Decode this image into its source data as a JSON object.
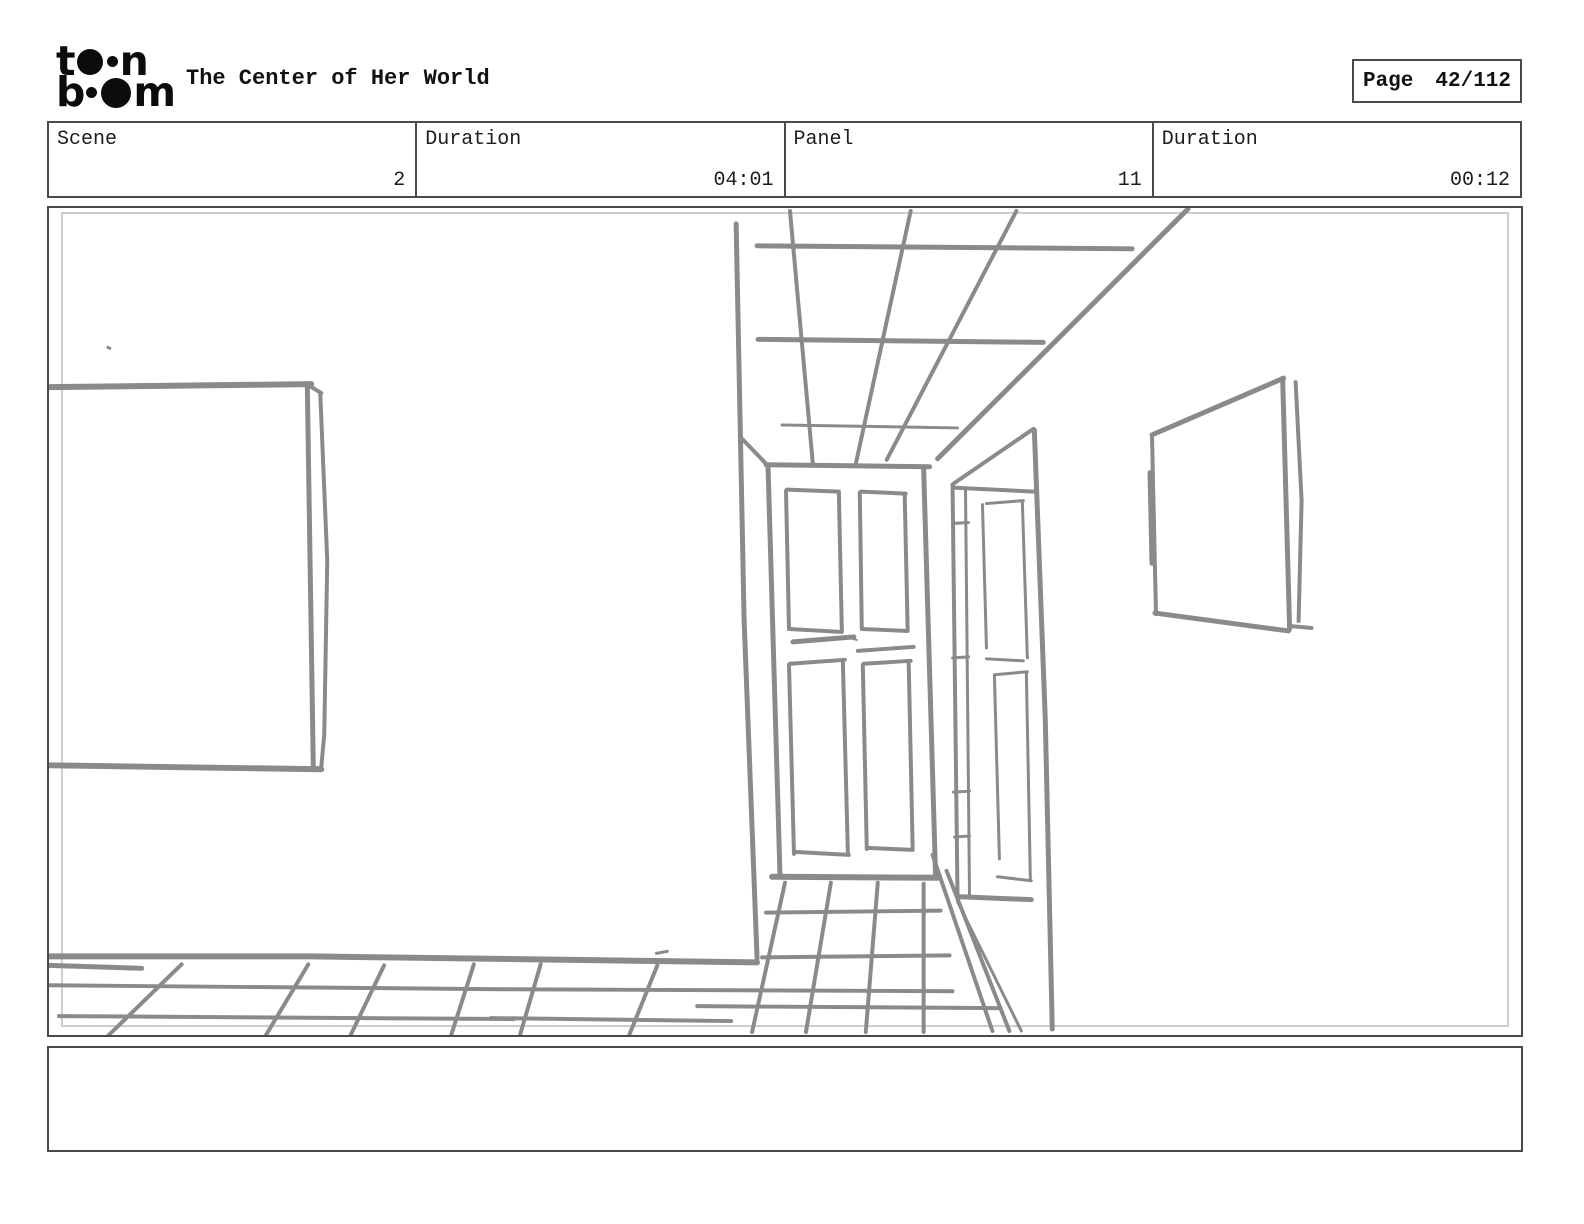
{
  "header": {
    "logo": {
      "name": "toon boom",
      "l1_start": "t",
      "l1_end": "n",
      "l2_start": "b",
      "l2_end": "m"
    },
    "title": "The Center of Her World",
    "page_label": "Page",
    "page_value": "42/112"
  },
  "info_table": {
    "cells": [
      {
        "label": "Scene",
        "value": "2"
      },
      {
        "label": "Duration",
        "value": "04:01"
      },
      {
        "label": "Panel",
        "value": "11"
      },
      {
        "label": "Duration",
        "value": "00:12"
      }
    ]
  },
  "caption": {
    "text": ""
  },
  "sketch": {
    "description": "hand-drawn perspective sketch: hallway with paneled door, open side door, picture frames on left and right walls, tiled floor and ceiling grid",
    "stroke_color": "#8a8a8a",
    "inner_border_color": "#bdbdbd",
    "strokes": [
      {
        "w": 4,
        "pts": [
          [
            790,
            209
          ],
          [
            813,
            464
          ]
        ]
      },
      {
        "w": 4,
        "pts": [
          [
            911,
            209
          ],
          [
            856,
            463
          ]
        ]
      },
      {
        "w": 4,
        "pts": [
          [
            1017,
            209
          ],
          [
            887,
            459
          ]
        ]
      },
      {
        "w": 5,
        "pts": [
          [
            1189,
            207
          ],
          [
            938,
            458
          ]
        ]
      },
      {
        "w": 5,
        "pts": [
          [
            757,
            244
          ],
          [
            1133,
            247
          ]
        ]
      },
      {
        "w": 5,
        "pts": [
          [
            758,
            338
          ],
          [
            1044,
            341
          ]
        ]
      },
      {
        "w": 3,
        "pts": [
          [
            782,
            424
          ],
          [
            958,
            427
          ]
        ]
      },
      {
        "w": 5,
        "pts": [
          [
            736,
            222
          ],
          [
            744,
            620
          ],
          [
            757,
            960
          ]
        ]
      },
      {
        "w": 4,
        "pts": [
          [
            740,
            436
          ],
          [
            768,
            465
          ]
        ]
      },
      {
        "w": 5,
        "pts": [
          [
            766,
            464
          ],
          [
            930,
            466
          ]
        ]
      },
      {
        "w": 5,
        "pts": [
          [
            768,
            466
          ],
          [
            780,
            877
          ]
        ]
      },
      {
        "w": 5,
        "pts": [
          [
            924,
            467
          ],
          [
            936,
            878
          ]
        ]
      },
      {
        "w": 6,
        "pts": [
          [
            772,
            878
          ],
          [
            938,
            879
          ]
        ]
      },
      {
        "w": 4,
        "pts": [
          [
            787,
            489
          ],
          [
            839,
            491
          ]
        ]
      },
      {
        "w": 4,
        "pts": [
          [
            786,
            490
          ],
          [
            789,
            629
          ]
        ]
      },
      {
        "w": 4,
        "pts": [
          [
            839,
            492
          ],
          [
            842,
            631
          ]
        ]
      },
      {
        "w": 4,
        "pts": [
          [
            789,
            629
          ],
          [
            842,
            632
          ]
        ]
      },
      {
        "w": 4,
        "pts": [
          [
            861,
            491
          ],
          [
            906,
            493
          ]
        ]
      },
      {
        "w": 4,
        "pts": [
          [
            860,
            492
          ],
          [
            862,
            629
          ]
        ]
      },
      {
        "w": 4,
        "pts": [
          [
            905,
            493
          ],
          [
            908,
            630
          ]
        ]
      },
      {
        "w": 4,
        "pts": [
          [
            862,
            629
          ],
          [
            908,
            631
          ]
        ]
      },
      {
        "w": 5,
        "pts": [
          [
            793,
            642
          ],
          [
            854,
            637
          ]
        ]
      },
      {
        "w": 4,
        "pts": [
          [
            858,
            651
          ],
          [
            914,
            647
          ]
        ]
      },
      {
        "w": 2,
        "pts": [
          [
            853,
            639
          ],
          [
            857,
            640
          ]
        ]
      },
      {
        "w": 4,
        "pts": [
          [
            790,
            664
          ],
          [
            845,
            660
          ]
        ]
      },
      {
        "w": 4,
        "pts": [
          [
            789,
            665
          ],
          [
            794,
            855
          ]
        ]
      },
      {
        "w": 4,
        "pts": [
          [
            843,
            661
          ],
          [
            848,
            853
          ]
        ]
      },
      {
        "w": 4,
        "pts": [
          [
            794,
            853
          ],
          [
            849,
            856
          ]
        ]
      },
      {
        "w": 4,
        "pts": [
          [
            864,
            664
          ],
          [
            911,
            661
          ]
        ]
      },
      {
        "w": 4,
        "pts": [
          [
            863,
            665
          ],
          [
            867,
            850
          ]
        ]
      },
      {
        "w": 4,
        "pts": [
          [
            909,
            662
          ],
          [
            913,
            849
          ]
        ]
      },
      {
        "w": 4,
        "pts": [
          [
            867,
            849
          ],
          [
            913,
            851
          ]
        ]
      },
      {
        "w": 4,
        "pts": [
          [
            953,
            484
          ],
          [
            958,
            899
          ]
        ]
      },
      {
        "w": 3,
        "pts": [
          [
            966,
            489
          ],
          [
            970,
            897
          ]
        ]
      },
      {
        "w": 3,
        "pts": [
          [
            953,
            523
          ],
          [
            969,
            522
          ]
        ]
      },
      {
        "w": 3,
        "pts": [
          [
            953,
            658
          ],
          [
            969,
            657
          ]
        ]
      },
      {
        "w": 3,
        "pts": [
          [
            954,
            793
          ],
          [
            970,
            792
          ]
        ]
      },
      {
        "w": 3,
        "pts": [
          [
            955,
            838
          ],
          [
            970,
            837
          ]
        ]
      },
      {
        "w": 4,
        "pts": [
          [
            954,
            487
          ],
          [
            1035,
            491
          ]
        ]
      },
      {
        "w": 4,
        "pts": [
          [
            954,
            483
          ],
          [
            1034,
            428
          ]
        ]
      },
      {
        "w": 5,
        "pts": [
          [
            1035,
            429
          ],
          [
            1046,
            720
          ],
          [
            1053,
            1031
          ]
        ]
      },
      {
        "w": 3,
        "pts": [
          [
            983,
            504
          ],
          [
            987,
            648
          ]
        ]
      },
      {
        "w": 3,
        "pts": [
          [
            987,
            503
          ],
          [
            1024,
            500
          ]
        ]
      },
      {
        "w": 3,
        "pts": [
          [
            1023,
            501
          ],
          [
            1028,
            658
          ]
        ]
      },
      {
        "w": 3,
        "pts": [
          [
            987,
            659
          ],
          [
            1024,
            661
          ]
        ]
      },
      {
        "w": 3,
        "pts": [
          [
            995,
            675
          ],
          [
            1028,
            672
          ]
        ]
      },
      {
        "w": 3,
        "pts": [
          [
            995,
            677
          ],
          [
            1000,
            860
          ]
        ]
      },
      {
        "w": 3,
        "pts": [
          [
            1027,
            673
          ],
          [
            1031,
            880
          ]
        ]
      },
      {
        "w": 3,
        "pts": [
          [
            998,
            878
          ],
          [
            1032,
            882
          ]
        ]
      },
      {
        "w": 5,
        "pts": [
          [
            958,
            898
          ],
          [
            1032,
            901
          ]
        ]
      },
      {
        "w": 4,
        "pts": [
          [
            933,
            856
          ],
          [
            993,
            1033
          ]
        ]
      },
      {
        "w": 4,
        "pts": [
          [
            947,
            872
          ],
          [
            1010,
            1033
          ]
        ]
      },
      {
        "w": 3,
        "pts": [
          [
            958,
            903
          ],
          [
            1022,
            1033
          ]
        ]
      },
      {
        "w": 5,
        "pts": [
          [
            1153,
            434
          ],
          [
            1285,
            377
          ]
        ]
      },
      {
        "w": 5,
        "pts": [
          [
            1284,
            377
          ],
          [
            1291,
            629
          ]
        ]
      },
      {
        "w": 4,
        "pts": [
          [
            1297,
            381
          ],
          [
            1303,
            500
          ],
          [
            1300,
            621
          ]
        ]
      },
      {
        "w": 4,
        "pts": [
          [
            1291,
            626
          ],
          [
            1313,
            628
          ]
        ]
      },
      {
        "w": 4,
        "pts": [
          [
            1153,
            435
          ],
          [
            1157,
            614
          ]
        ]
      },
      {
        "w": 5,
        "pts": [
          [
            1151,
            472
          ],
          [
            1153,
            563
          ]
        ]
      },
      {
        "w": 5,
        "pts": [
          [
            1156,
            613
          ],
          [
            1290,
            631
          ]
        ]
      },
      {
        "w": 6,
        "pts": [
          [
            47,
            386
          ],
          [
            310,
            383
          ]
        ]
      },
      {
        "w": 5,
        "pts": [
          [
            306,
            384
          ],
          [
            312,
            767
          ]
        ]
      },
      {
        "w": 4,
        "pts": [
          [
            307,
            384
          ],
          [
            320,
            392
          ]
        ]
      },
      {
        "w": 4,
        "pts": [
          [
            319,
            393
          ],
          [
            326,
            560
          ],
          [
            323,
            735
          ],
          [
            320,
            768
          ]
        ]
      },
      {
        "w": 6,
        "pts": [
          [
            48,
            766
          ],
          [
            320,
            770
          ]
        ]
      },
      {
        "w": 3,
        "pts": [
          [
            106,
            346
          ],
          [
            108,
            347
          ]
        ]
      },
      {
        "w": 6,
        "pts": [
          [
            46,
            958
          ],
          [
            310,
            958
          ],
          [
            757,
            964
          ]
        ]
      },
      {
        "w": 5,
        "pts": [
          [
            46,
            967
          ],
          [
            140,
            970
          ]
        ]
      },
      {
        "w": 4,
        "pts": [
          [
            46,
            987
          ],
          [
            500,
            991
          ],
          [
            953,
            993
          ]
        ]
      },
      {
        "w": 4,
        "pts": [
          [
            57,
            1018
          ],
          [
            513,
            1021
          ]
        ]
      },
      {
        "w": 4,
        "pts": [
          [
            490,
            1020
          ],
          [
            731,
            1023
          ]
        ]
      },
      {
        "w": 4,
        "pts": [
          [
            697,
            1008
          ],
          [
            1000,
            1010
          ]
        ]
      },
      {
        "w": 4,
        "pts": [
          [
            180,
            966
          ],
          [
            106,
            1038
          ]
        ]
      },
      {
        "w": 4,
        "pts": [
          [
            307,
            966
          ],
          [
            264,
            1038
          ]
        ]
      },
      {
        "w": 4,
        "pts": [
          [
            383,
            967
          ],
          [
            349,
            1038
          ]
        ]
      },
      {
        "w": 4,
        "pts": [
          [
            473,
            966
          ],
          [
            450,
            1038
          ]
        ]
      },
      {
        "w": 4,
        "pts": [
          [
            540,
            966
          ],
          [
            519,
            1038
          ]
        ]
      },
      {
        "w": 4,
        "pts": [
          [
            657,
            967
          ],
          [
            628,
            1039
          ]
        ]
      },
      {
        "w": 3,
        "pts": [
          [
            656,
            955
          ],
          [
            667,
            953
          ]
        ]
      },
      {
        "w": 4,
        "pts": [
          [
            785,
            884
          ],
          [
            752,
            1034
          ]
        ]
      },
      {
        "w": 4,
        "pts": [
          [
            831,
            884
          ],
          [
            806,
            1034
          ]
        ]
      },
      {
        "w": 4,
        "pts": [
          [
            878,
            884
          ],
          [
            866,
            1034
          ]
        ]
      },
      {
        "w": 4,
        "pts": [
          [
            924,
            885
          ],
          [
            924,
            1034
          ]
        ]
      },
      {
        "w": 4,
        "pts": [
          [
            766,
            914
          ],
          [
            941,
            912
          ]
        ]
      },
      {
        "w": 4,
        "pts": [
          [
            762,
            959
          ],
          [
            950,
            957
          ]
        ]
      }
    ]
  }
}
